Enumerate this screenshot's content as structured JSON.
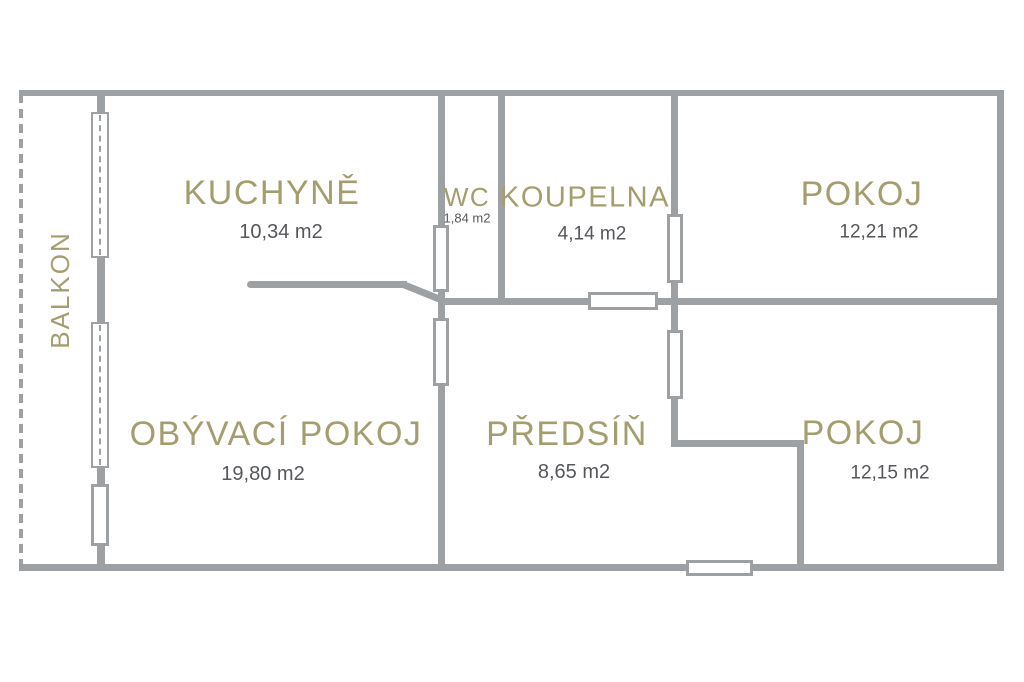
{
  "colors": {
    "wall": "#9ea1a4",
    "label": "#a49e6e",
    "area": "#55575a",
    "bg": "#ffffff"
  },
  "floor_plan": {
    "balcony": {
      "label": "BALKON"
    },
    "rooms": [
      {
        "id": "kuchyne",
        "label": "KUCHYNĚ",
        "area": "10,34 m2"
      },
      {
        "id": "wc",
        "label": "WC",
        "area": "1,84 m2"
      },
      {
        "id": "koupelna",
        "label": "KOUPELNA",
        "area": "4,14 m2"
      },
      {
        "id": "pokoj_top",
        "label": "POKOJ",
        "area": "12,21 m2"
      },
      {
        "id": "obyvaci_pokoj",
        "label": "OBÝVACÍ POKOJ",
        "area": "19,80 m2"
      },
      {
        "id": "predsin",
        "label": "PŘEDSÍŇ",
        "area": "8,65 m2"
      },
      {
        "id": "pokoj_bottom",
        "label": "POKOJ",
        "area": "12,15 m2"
      }
    ],
    "symbols": {
      "window": "window-icon",
      "door": "door-icon",
      "railing": "balcony-railing-icon"
    }
  }
}
